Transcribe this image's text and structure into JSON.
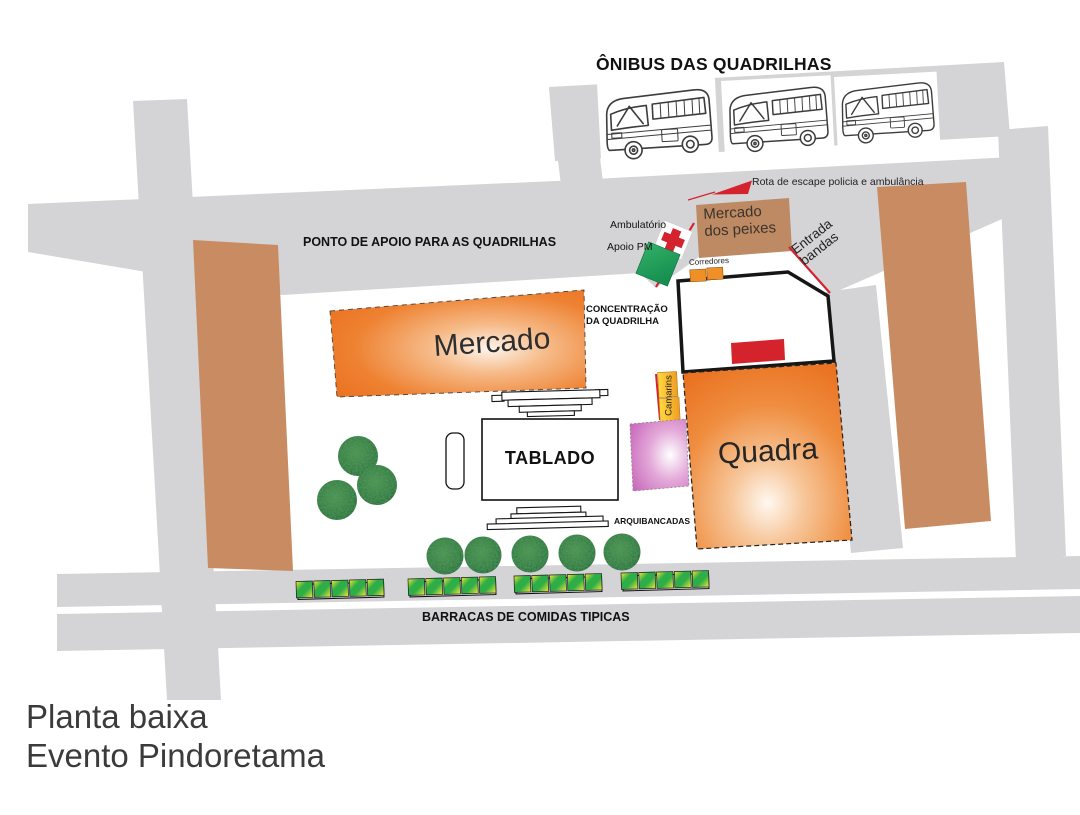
{
  "page_title": {
    "line1": "Planta baixa",
    "line2": "Evento Pindoretama"
  },
  "bus_area": {
    "title": "ÔNIBUS DAS QUADRILHAS",
    "bus_count": 3
  },
  "roads": {
    "escape_route_label": "Rota de escape policia e ambulância",
    "support_point_label": "PONTO DE APOIO PARA AS QUADRILHAS",
    "food_stalls_label": "BARRACAS DE COMIDAS TIPICAS"
  },
  "markers": {
    "ambulatory_label": "Ambulatório",
    "police_support_label": "Apoio PM",
    "fish_market_line1": "Mercado",
    "fish_market_line2": "dos peixes",
    "bands_entrance_line1": "Entrada",
    "bands_entrance_line2": "bandas",
    "corridors_label": "Corredores",
    "concentration_line1": "CONCENTRAÇÃO",
    "concentration_line2": "DA QUADRILHA",
    "dressing_rooms_label": "Camarins"
  },
  "venues": {
    "market_label": "Mercado",
    "stage_label": "TABLADO",
    "bleachers_label": "ARQUIBANCADAS",
    "court_label": "Quadra"
  },
  "map_stats": {
    "tree_cluster_count": 3,
    "tree_row_count": 5,
    "stall_group_count": 4,
    "stalls_per_group": 5
  },
  "colors": {
    "road": "#d4d4d6",
    "building": "#c98c62",
    "fish_market": "#bd8a64",
    "orange_venue": "#ec7423",
    "red_accent": "#d5232e",
    "pm_green": "#1ea45c",
    "stall_green": "#2fae47",
    "stall_yellow": "#f2ea36",
    "pink_tent": "#c765ba",
    "camarins_yellow": "#ffd23c",
    "corridor_orange": "#ef8f25",
    "tree_green": "#3a7b3e"
  }
}
